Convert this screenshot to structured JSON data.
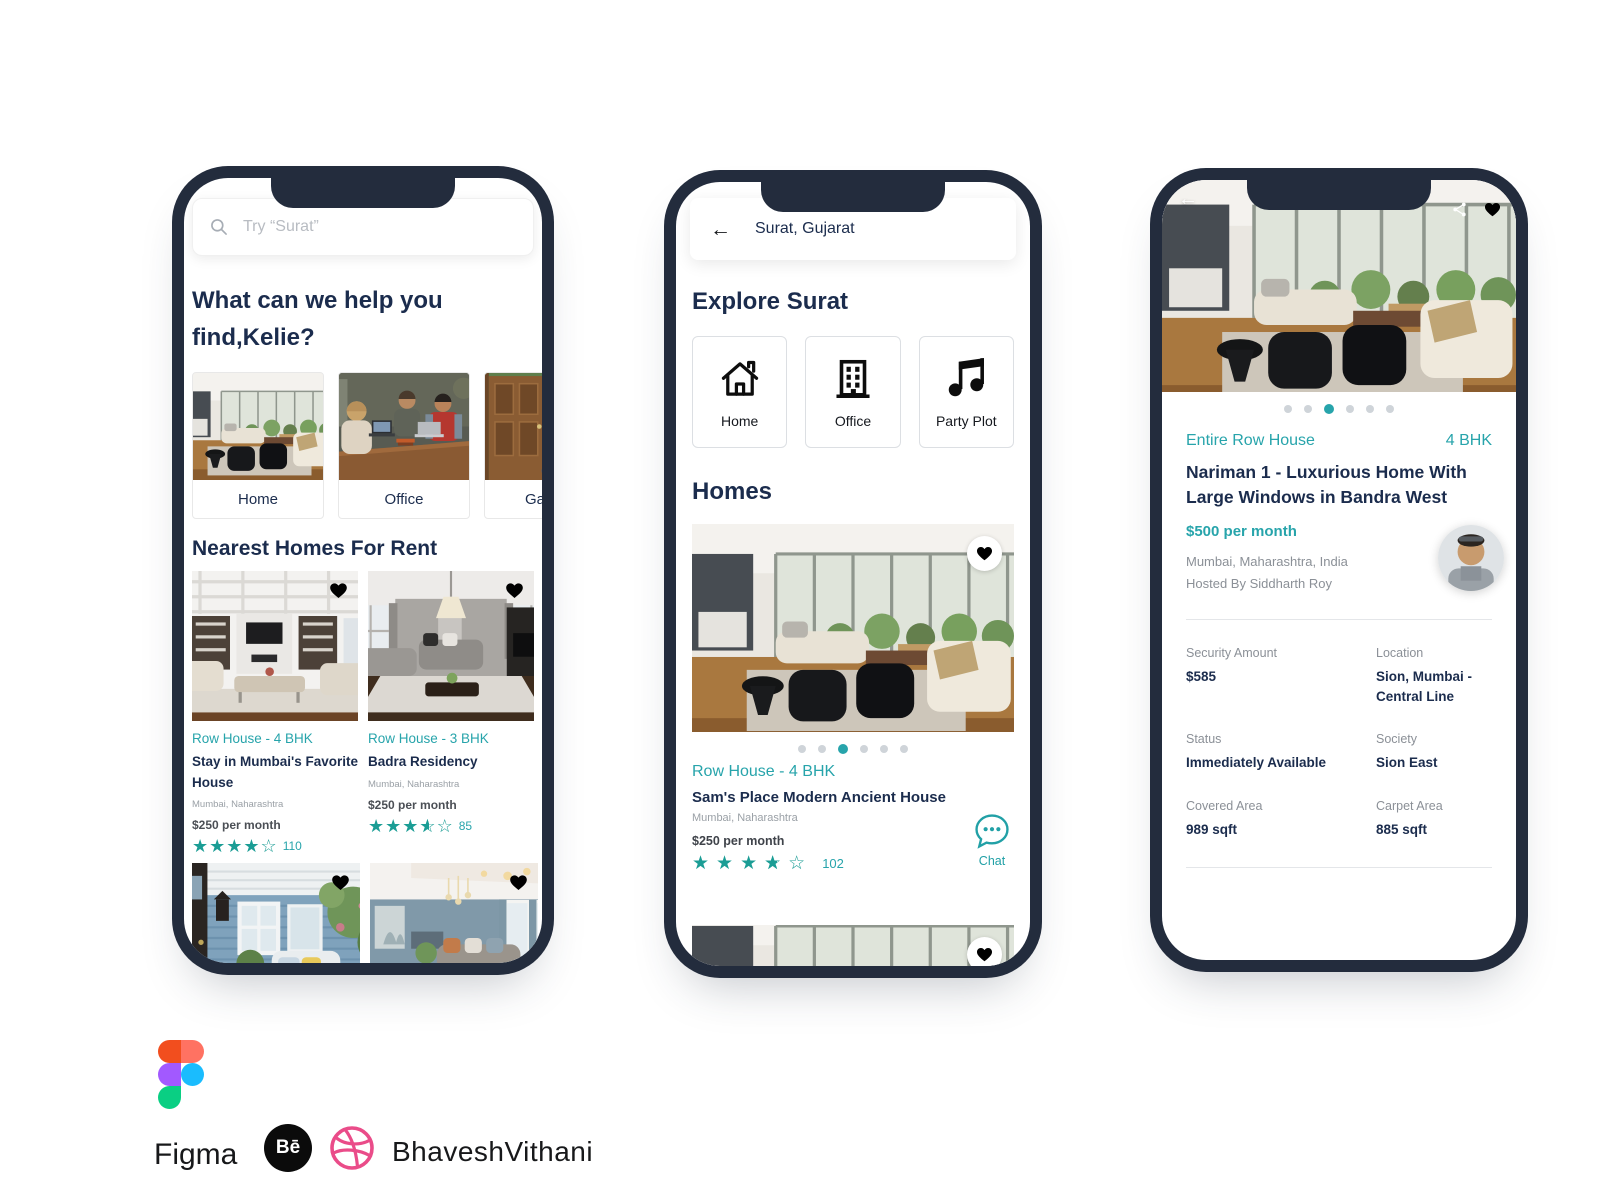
{
  "colors": {
    "teal_accent": "#27a4ab",
    "heart_cyan": "#45c1ca",
    "navy_text": "#1b2c4d",
    "bezel": "#232c3d",
    "dribbble_pink": "#ea4c89",
    "figma_palette": [
      "#f24e1e",
      "#ff7262",
      "#a259ff",
      "#1abcfe",
      "#0acf83"
    ]
  },
  "phone1": {
    "search_placeholder": "Try “Surat”",
    "heading": "What can we help you find,Kelie?",
    "categories": [
      {
        "label": "Home"
      },
      {
        "label": "Office"
      },
      {
        "label": "Garden"
      }
    ],
    "section_title": "Nearest Homes For Rent",
    "listings": [
      {
        "category": "Row House - 4 BHK",
        "title": "Stay in Mumbai's Favorite House",
        "location": "Mumbai, Naharashtra",
        "price": "$250 per month",
        "rating_count": "110"
      },
      {
        "category": "Row House - 3 BHK",
        "title": "Badra Residency",
        "location": "Mumbai, Naharashtra",
        "price": "$250 per month",
        "rating_count": "85"
      }
    ]
  },
  "phone2": {
    "location_bar": "Surat, Gujarat",
    "heading": "Explore Surat",
    "categories": [
      {
        "label": "Home"
      },
      {
        "label": "Office"
      },
      {
        "label": "Party Plot"
      }
    ],
    "section_title": "Homes",
    "listing": {
      "category": "Row House - 4 BHK",
      "title": "Sam's Place Modern Ancient House",
      "location": "Mumbai, Naharashtra",
      "price": "$250 per month",
      "rating_count": "102",
      "chat_label": "Chat"
    }
  },
  "phone3": {
    "property_type": "Entire Row House",
    "bhk": "4 BHK",
    "title": "Nariman 1 - Luxurious Home With Large Windows in Bandra West",
    "price": "$500 per month",
    "location": "Mumbai, Maharashtra, India",
    "host": "Hosted By Siddharth Roy",
    "details": [
      {
        "label": "Security Amount",
        "value": "$585"
      },
      {
        "label": "Location",
        "value": "Sion, Mumbai - Central Line"
      },
      {
        "label": "Status",
        "value": "Immediately Available"
      },
      {
        "label": "Society",
        "value": "Sion East"
      },
      {
        "label": "Covered Area",
        "value": "989 sqft"
      },
      {
        "label": "Carpet Area",
        "value": "885 sqft"
      }
    ]
  },
  "footer": {
    "figma_label": "Figma",
    "behance_label": "Bē",
    "author": "BhaveshVithani"
  }
}
